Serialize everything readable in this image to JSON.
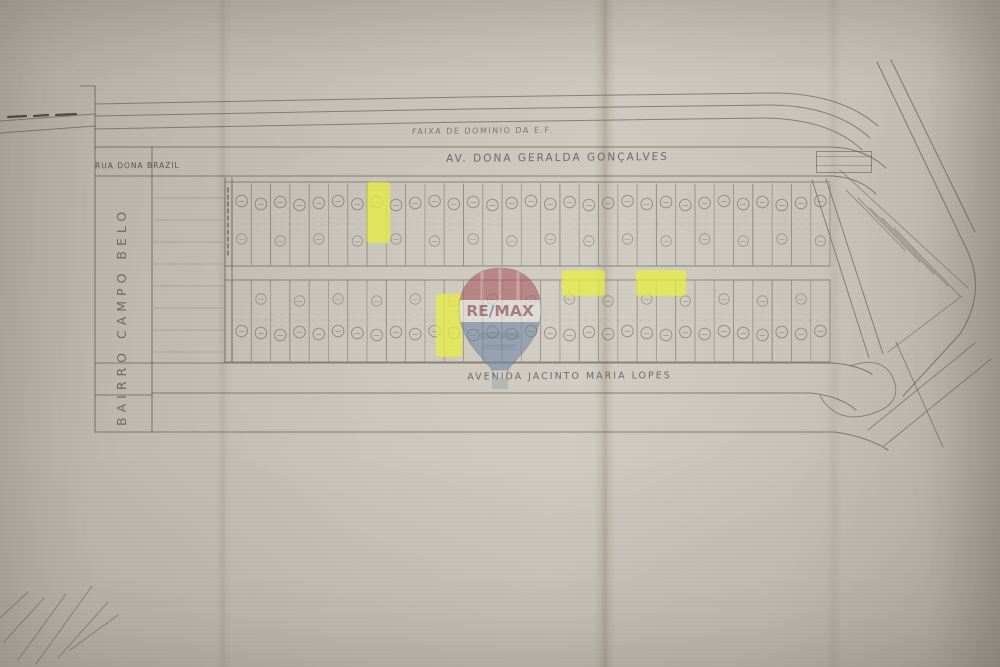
{
  "labels": {
    "top_margin_note": "FAIXA DE DOMINIO DA E.F.",
    "street_top_left": "RUA DONA BRAZIL",
    "avenue_top": "AV. DONA GERALDA GONÇALVES",
    "district_vertical": "BAIRRO CAMPO BELO",
    "avenue_bottom": "AVENIDA JACINTO MARIA LOPES"
  },
  "watermark": {
    "brand": "RE/MAX",
    "brand_re": "RE",
    "brand_slash": "/",
    "brand_max": "MAX",
    "icon": "hot-air-balloon-icon",
    "colors": {
      "top": "#a8545d",
      "band": "#eae8e4",
      "bottom": "#6d85a4",
      "text": "#8f4450",
      "slash": "#50689a"
    }
  },
  "highlights": {
    "color": "#e9f03b",
    "lots": [
      {
        "id": "lot-highlight-1",
        "x": 367,
        "y": 182,
        "w": 23,
        "h": 61
      },
      {
        "id": "lot-highlight-2",
        "x": 436,
        "y": 294,
        "w": 26,
        "h": 63
      },
      {
        "id": "lot-highlight-3",
        "x": 562,
        "y": 270,
        "w": 43,
        "h": 26
      },
      {
        "id": "lot-highlight-4",
        "x": 636,
        "y": 270,
        "w": 50,
        "h": 26
      }
    ]
  },
  "map": {
    "grid": {
      "columns": 31,
      "x0": 232,
      "x1": 830,
      "top_block": [
        182,
        266
      ],
      "bottom_block": [
        280,
        362
      ]
    },
    "ink_color": "#5f594f",
    "paper_color": "#c6c0b6"
  }
}
